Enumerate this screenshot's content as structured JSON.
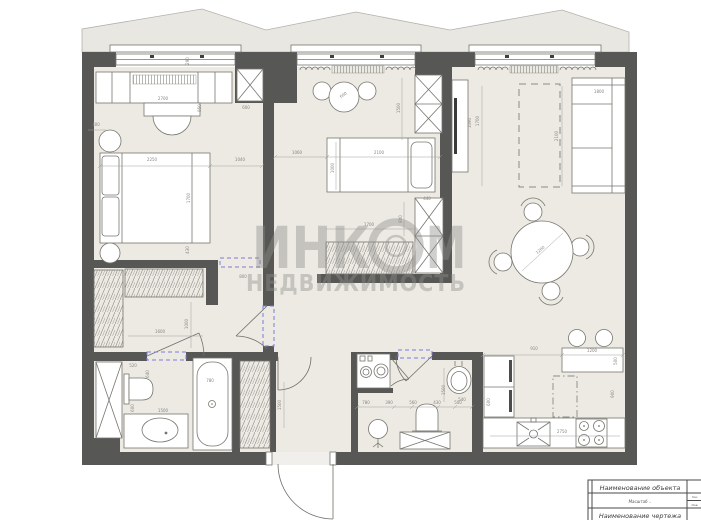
{
  "watermark": {
    "brand_part1": "ИНК",
    "brand_part2": "М",
    "logo": "ring-logo",
    "subtitle": "НЕДВИЖИМОСТЬ",
    "color": "#b7b6b2"
  },
  "title_block": {
    "object_row": "Наименование объекта",
    "scale_row": "Масштаб  ..",
    "drawing_row": "Наименование чертежа",
    "side_cell_top": "Зак.",
    "side_cell_bottom": "Инв."
  },
  "colors": {
    "wall": "#575756",
    "floor": "#edeae4",
    "terrace": "#e9e7e1",
    "dimension_text": "#87867f",
    "door_opening_dashed": "#7b7bd8",
    "furniture_line": "#76756e"
  },
  "dimensions": [
    {
      "t": "290",
      "x": 189,
      "y": 61,
      "r": -90
    },
    {
      "t": "2700",
      "x": 163,
      "y": 100,
      "r": 0
    },
    {
      "t": "400",
      "x": 96,
      "y": 126,
      "r": 0
    },
    {
      "t": "950",
      "x": 201,
      "y": 108,
      "r": -90
    },
    {
      "t": "600",
      "x": 246,
      "y": 109,
      "r": 0
    },
    {
      "t": "2250",
      "x": 152,
      "y": 161,
      "r": 0
    },
    {
      "t": "1040",
      "x": 240,
      "y": 161,
      "r": 0
    },
    {
      "t": "1700",
      "x": 190,
      "y": 198,
      "r": -90
    },
    {
      "t": "430",
      "x": 189,
      "y": 250,
      "r": -90
    },
    {
      "t": "1060",
      "x": 297,
      "y": 154,
      "r": 0
    },
    {
      "t": "2100",
      "x": 379,
      "y": 154,
      "r": 0
    },
    {
      "t": "1000",
      "x": 334,
      "y": 168,
      "r": -90
    },
    {
      "t": "600",
      "x": 344,
      "y": 96,
      "r": -35
    },
    {
      "t": "1500",
      "x": 400,
      "y": 108,
      "r": -90
    },
    {
      "t": "440",
      "x": 427,
      "y": 200,
      "r": 0
    },
    {
      "t": "800",
      "x": 402,
      "y": 219,
      "r": -90
    },
    {
      "t": "1700",
      "x": 369,
      "y": 226,
      "r": 0
    },
    {
      "t": "1090",
      "x": 471,
      "y": 123,
      "r": -90
    },
    {
      "t": "1700",
      "x": 479,
      "y": 121,
      "r": -90
    },
    {
      "t": "2100",
      "x": 558,
      "y": 136,
      "r": -90
    },
    {
      "t": "1800",
      "x": 599,
      "y": 93,
      "r": 0
    },
    {
      "t": "1200",
      "x": 541,
      "y": 251,
      "r": -40
    },
    {
      "t": "800",
      "x": 243,
      "y": 278,
      "r": 0
    },
    {
      "t": "1000",
      "x": 188,
      "y": 324,
      "r": -90
    },
    {
      "t": "1600",
      "x": 160,
      "y": 333,
      "r": 0
    },
    {
      "t": "520",
      "x": 133,
      "y": 367,
      "r": 0
    },
    {
      "t": "640",
      "x": 149,
      "y": 374,
      "r": -90
    },
    {
      "t": "600",
      "x": 134,
      "y": 408,
      "r": -90
    },
    {
      "t": "1500",
      "x": 163,
      "y": 412,
      "r": 0
    },
    {
      "t": "780",
      "x": 210,
      "y": 382,
      "r": 0
    },
    {
      "t": "1500",
      "x": 281,
      "y": 405,
      "r": -90
    },
    {
      "t": "780",
      "x": 366,
      "y": 404,
      "r": 0
    },
    {
      "t": "390",
      "x": 389,
      "y": 404,
      "r": 0
    },
    {
      "t": "560",
      "x": 413,
      "y": 404,
      "r": 0
    },
    {
      "t": "430",
      "x": 437,
      "y": 404,
      "r": 0
    },
    {
      "t": "500",
      "x": 458,
      "y": 404,
      "r": 0
    },
    {
      "t": "1500",
      "x": 445,
      "y": 390,
      "r": -90
    },
    {
      "t": "540",
      "x": 462,
      "y": 401,
      "r": 0
    },
    {
      "t": "600",
      "x": 490,
      "y": 402,
      "r": -90
    },
    {
      "t": "910",
      "x": 534,
      "y": 350,
      "r": 0
    },
    {
      "t": "1200",
      "x": 592,
      "y": 352,
      "r": 0
    },
    {
      "t": "500",
      "x": 617,
      "y": 361,
      "r": -90
    },
    {
      "t": "900",
      "x": 614,
      "y": 394,
      "r": -90
    },
    {
      "t": "2750",
      "x": 562,
      "y": 433,
      "r": 0
    }
  ]
}
